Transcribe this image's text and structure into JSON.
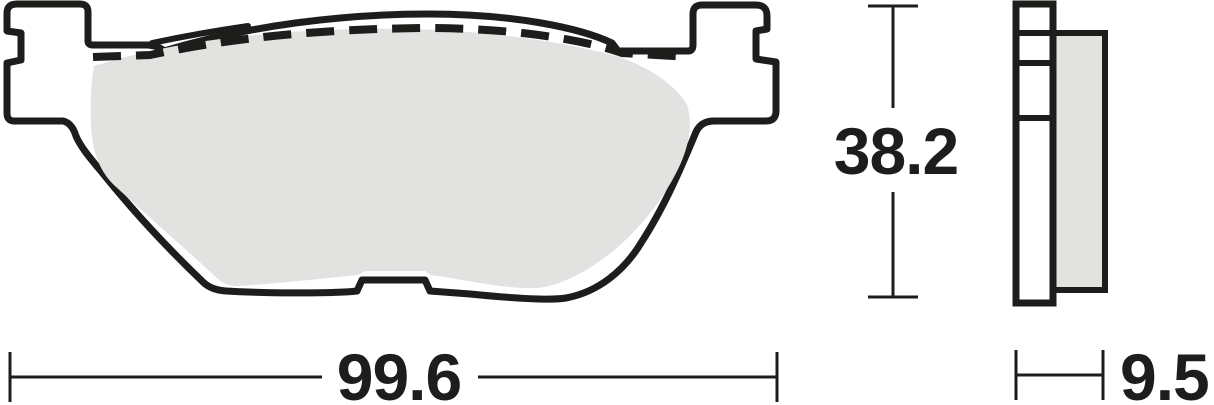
{
  "drawing": {
    "kind": "brake-pad-dimension-diagram",
    "views": [
      "front-profile",
      "side-profile"
    ]
  },
  "dimensions": {
    "width": "99.6",
    "height": "38.2",
    "thickness": "9.5"
  },
  "colors": {
    "line": "#1d1d1b",
    "friction": "#e2e2e1",
    "background": "#ffffff"
  }
}
